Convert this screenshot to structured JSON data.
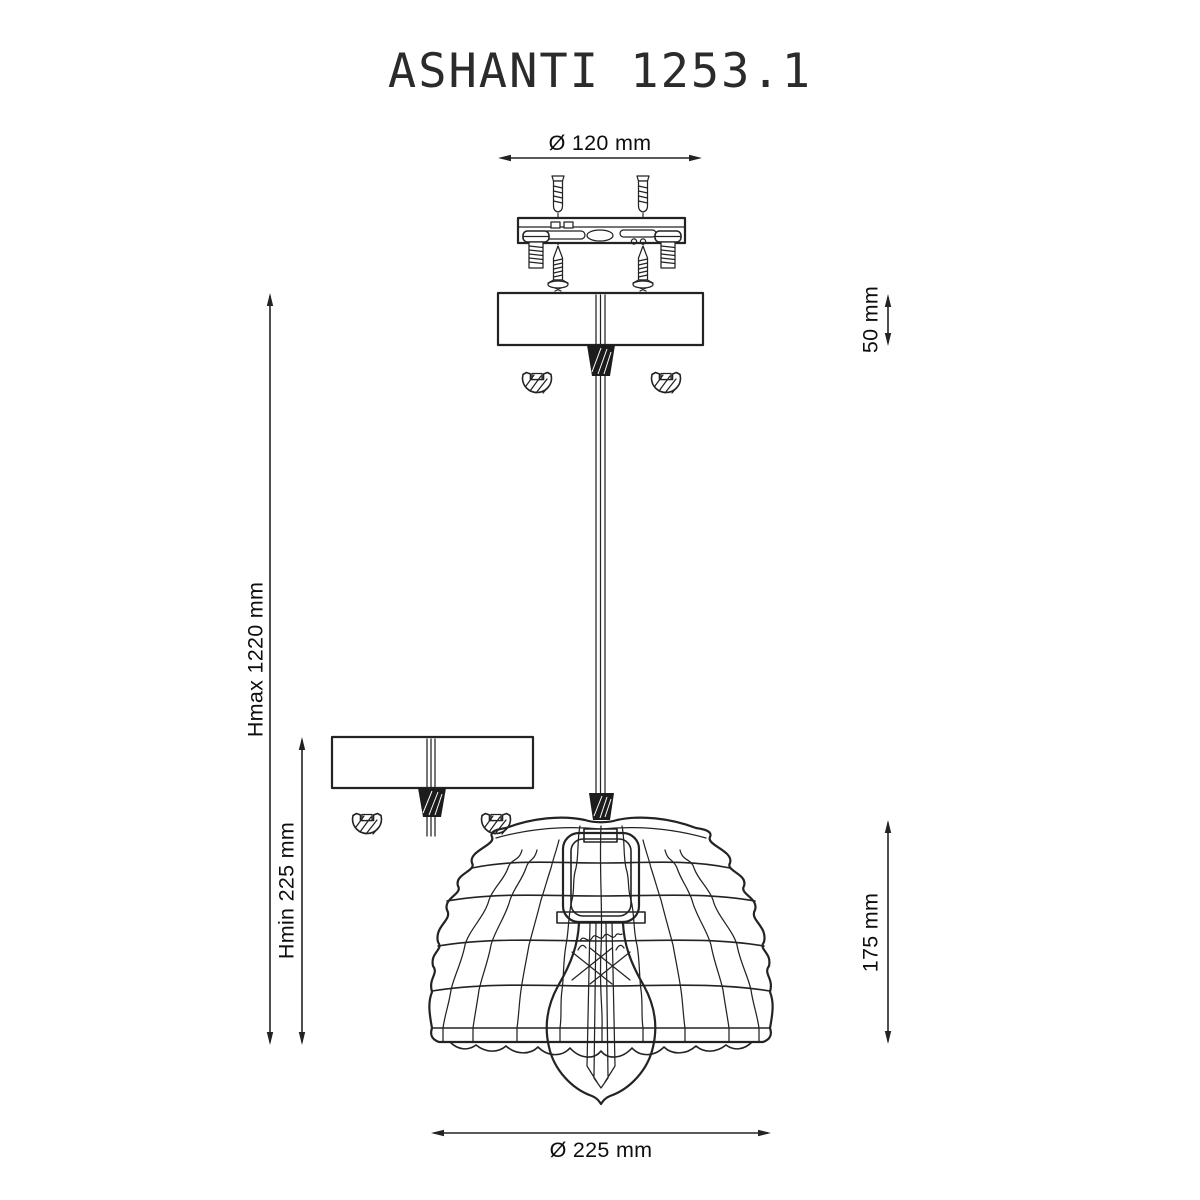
{
  "title": "ASHANTI 1253.1",
  "dimensions": {
    "plate_diameter": "Ø 120 mm",
    "canopy_height": "50 mm",
    "max_height": "Hmax 1220 mm",
    "min_height": "Hmin 225 mm",
    "shade_height": "175 mm",
    "shade_diameter": "Ø 225 mm"
  },
  "colors": {
    "line": "#232323",
    "text": "#0e0e0e",
    "background": "#ffffff"
  }
}
